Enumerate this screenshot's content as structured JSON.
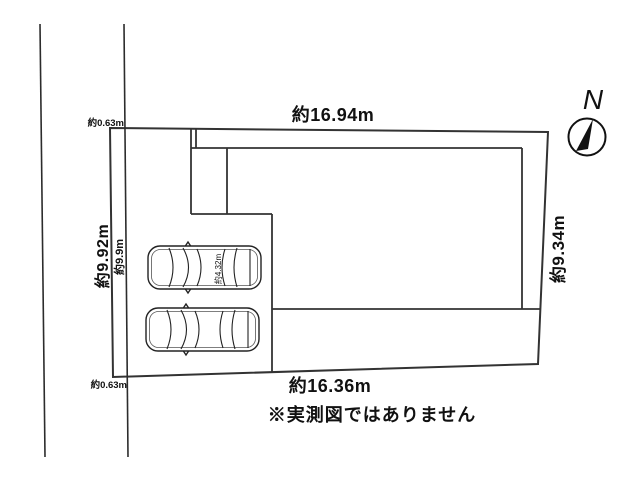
{
  "plot_diagram": {
    "north_label": "N",
    "note": "※実測図ではありません",
    "dimensions": {
      "top_edge": "約16.94m",
      "bottom_edge": "約16.36m",
      "right_edge": "約9.34m",
      "left_edge_outer": "約9.92m",
      "left_strip_inner": "約9.9m",
      "strip_width_top": "約0.63m",
      "strip_width_bottom": "約0.63m",
      "car_length": "約4.32m"
    },
    "cars_count": 2,
    "colors": {
      "plot_fill": "#d0e5bd",
      "boundary_line": "#333333",
      "car_fill": "#ffffff",
      "background": "#ffffff"
    }
  }
}
